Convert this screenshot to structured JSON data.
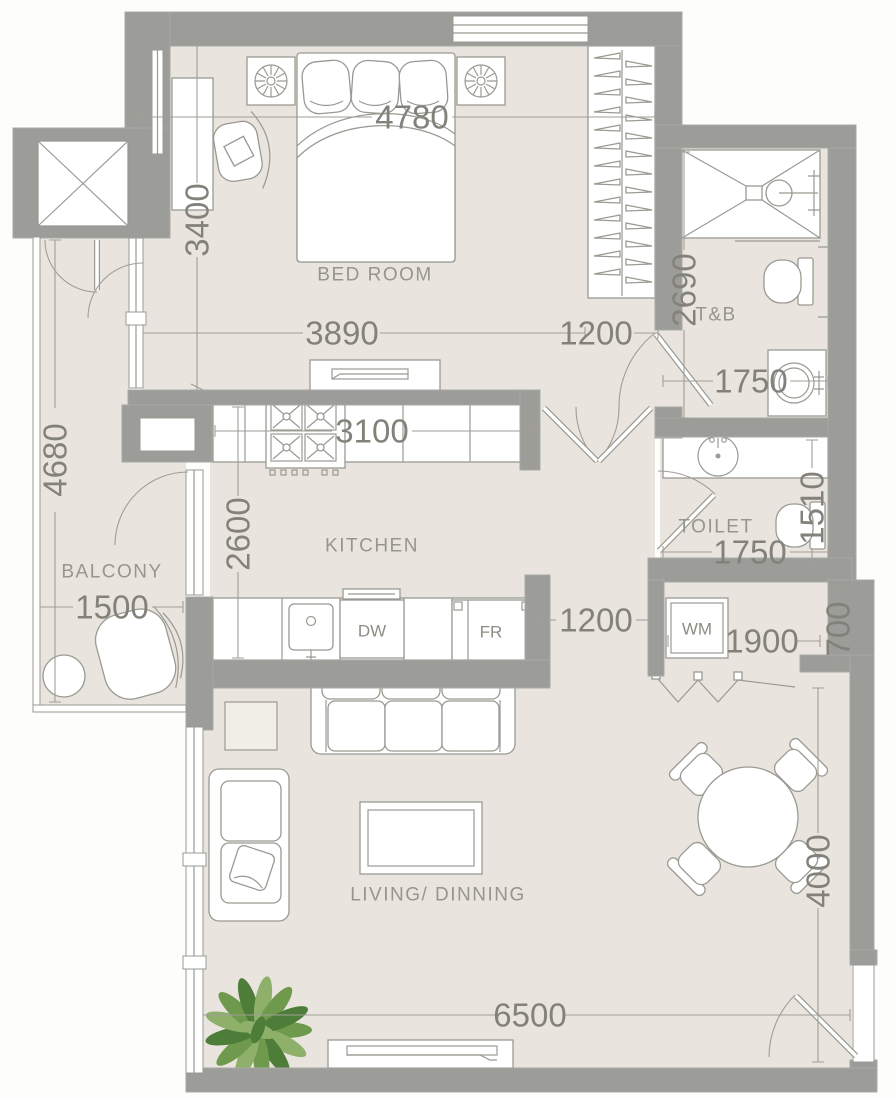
{
  "plan": {
    "colors": {
      "wall": "#9c9c98",
      "wall_edge": "#a9a9a5",
      "floor": "#e9e5de",
      "line": "#9a9a92",
      "dim": "#a29e96",
      "text": "#82827a",
      "room_text": "#96968c",
      "plant_dark": "#4e7d3a",
      "plant_mid": "#6f9a4e",
      "plant_light": "#8fb06a"
    },
    "rooms": {
      "bedroom": "BED ROOM",
      "balcony": "BALCONY",
      "kitchen": "KITCHEN",
      "t_and_b": "T&B",
      "toilet": "TOILET",
      "living": "LIVING/ DINNING"
    },
    "appliances": {
      "dishwasher": "DW",
      "fridge": "FR",
      "washing_machine": "WM"
    },
    "dimensions": {
      "bedroom_width": "4780",
      "bedroom_upper_height": "3400",
      "bedroom_lower_width": "3890",
      "closet_width": "1200",
      "tb_height": "2690",
      "tb_width": "1750",
      "balcony_height": "4680",
      "balcony_width": "1500",
      "kitchen_width": "3100",
      "kitchen_height": "2600",
      "toilet_height": "1510",
      "toilet_width": "1750",
      "hall_width": "1200",
      "laundry_width": "1900",
      "laundry_height": "700",
      "living_width": "6500",
      "living_height": "4000"
    }
  }
}
